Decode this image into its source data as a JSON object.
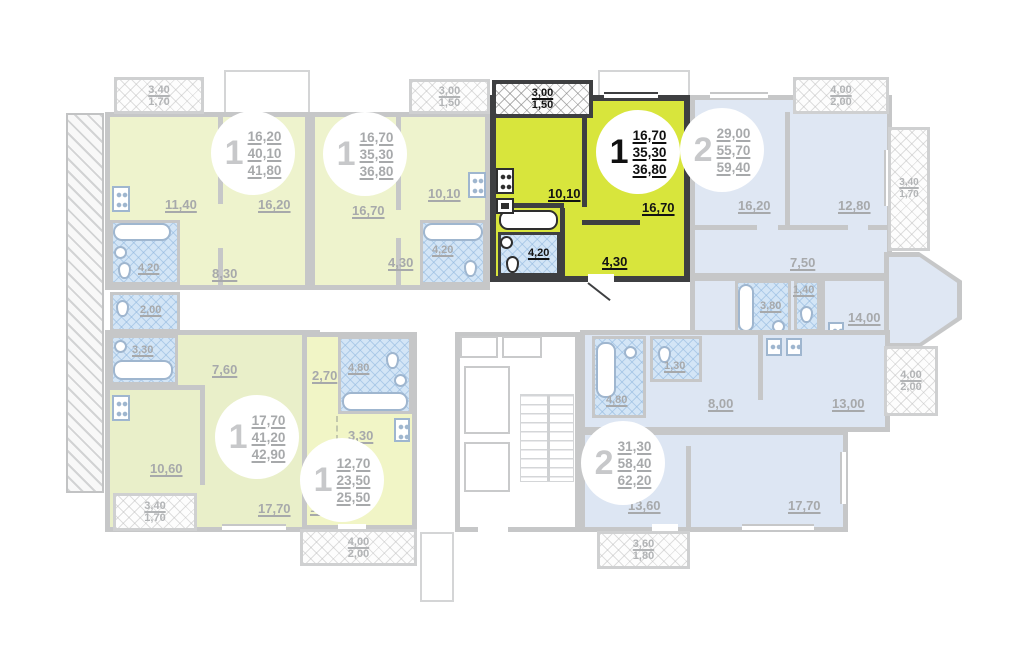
{
  "colors": {
    "highlight_fill": "#d8e53c",
    "highlight_wall": "#3e3f41",
    "unit_yellow": "#eef3cd",
    "unit_green": "#e9efc9",
    "unit_blue": "#dfe7f3",
    "bath_blue": "#d3e5f6",
    "wall_gray": "#c6c7c8",
    "label_gray": "#a7a9ab"
  },
  "selected_apartment": "a3",
  "apartments": {
    "a1": {
      "num": "1",
      "v": [
        "16,20",
        "40,10",
        "41,80"
      ],
      "kitchen": "11,40",
      "living": "16,20",
      "hall": "8,30",
      "bath": "4,20",
      "wc": "2,00",
      "balc": [
        "3,40",
        "1,70"
      ]
    },
    "a2": {
      "num": "1",
      "v": [
        "16,70",
        "35,30",
        "36,80"
      ],
      "living": "16,70",
      "kitchen": "10,10",
      "bath": "4,20",
      "hall": "4,30",
      "balc": [
        "3,00",
        "1,50"
      ]
    },
    "a3": {
      "num": "1",
      "v": [
        "16,70",
        "35,30",
        "36,80"
      ],
      "kitchen": "10,10",
      "living": "16,70",
      "bath": "4,20",
      "hall": "4,30",
      "balc": [
        "3,00",
        "1,50"
      ],
      "selected": true
    },
    "a4": {
      "num": "2",
      "v": [
        "29,00",
        "55,70",
        "59,40"
      ],
      "living": "16,20",
      "bedroom": "12,80",
      "hall": "7,50",
      "wardrobe": "1,40",
      "bath": "3,80",
      "kitchen": "14,00",
      "balc_top": [
        "4,00",
        "2,00"
      ],
      "balc_side": [
        "3,40",
        "1,70"
      ]
    },
    "a5": {
      "num": "1",
      "v": [
        "17,70",
        "41,20",
        "42,90"
      ],
      "bath": "3,30",
      "hall": "7,60",
      "kitchen": "10,60",
      "living": "17,70",
      "balc": [
        "3,40",
        "1,70"
      ]
    },
    "a6": {
      "num": "1",
      "v": [
        "12,70",
        "23,50",
        "25,50"
      ],
      "hall": "2,70",
      "bath": "4,80",
      "kitchen": "3,30",
      "living": "12,70",
      "balc": [
        "4,00",
        "2,00"
      ]
    },
    "a7": {
      "num": "2",
      "v": [
        "31,30",
        "58,40",
        "62,20"
      ],
      "bath": "4,80",
      "wc": "1,30",
      "hall": "8,00",
      "kitchen": "13,00",
      "room1": "13,60",
      "room2": "17,70",
      "balc_side": [
        "4,00",
        "2,00"
      ],
      "balc_bottom": [
        "3,60",
        "1,80"
      ]
    }
  }
}
